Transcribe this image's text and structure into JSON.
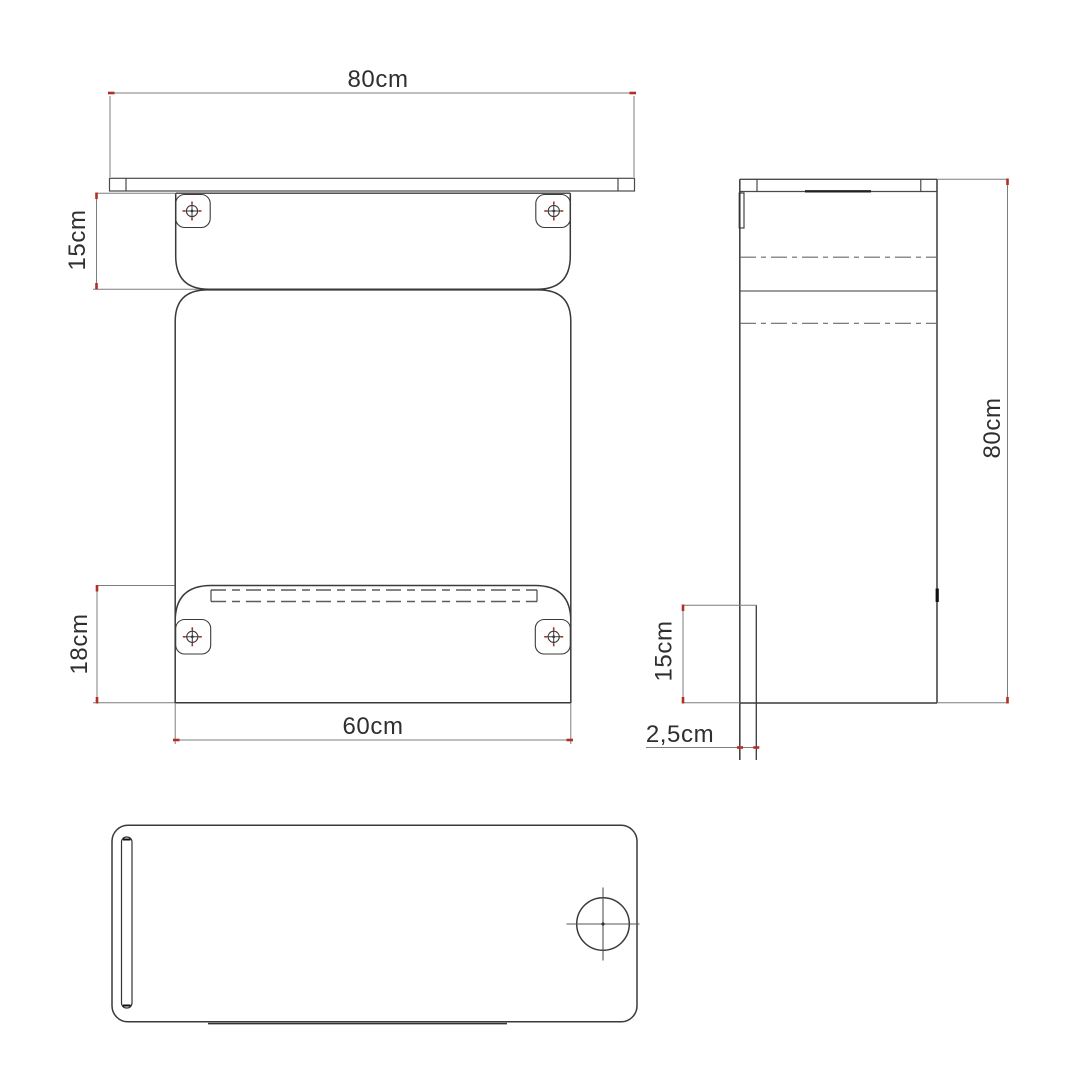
{
  "colors": {
    "outline": "#3a3a3a",
    "dim": "#7d7d7d",
    "accent_red": "#b03024",
    "text": "#2f2f2f",
    "background": "#ffffff"
  },
  "front_view": {
    "width_label": "80cm",
    "upper_bracket_height_label": "15cm",
    "lower_bracket_height_label": "18cm",
    "bottom_width_label": "60cm"
  },
  "side_view": {
    "height_label": "80cm",
    "bottom_bracket_height_label": "15cm",
    "panel_thickness_label": "2,5cm"
  },
  "icons": {
    "screw": "screw-crosshair-icon",
    "grommet": "grommet-hole-icon"
  }
}
